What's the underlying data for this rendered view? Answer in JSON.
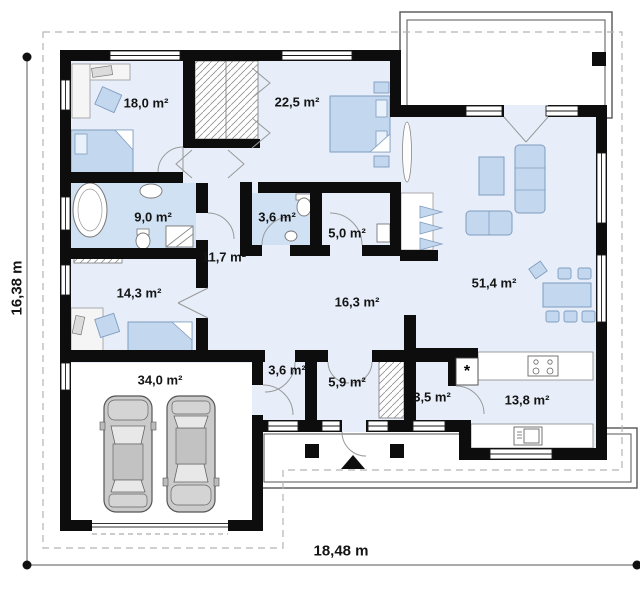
{
  "plan": {
    "rooms": {
      "bedroom_1": "18,0 m²",
      "bedroom_2": "22,5 m²",
      "bathroom": "9,0 m²",
      "wc": "3,6 m²",
      "pantry": "5,0 m²",
      "hall": "11,7 m²",
      "bedroom_3": "14,3 m²",
      "corridor": "16,3 m²",
      "living_room": "51,4 m²",
      "garage": "34,0 m²",
      "vestibule": "3,6 m²",
      "entry": "5,9 m²",
      "utility": "3,5 m²",
      "kitchen": "13,8 m²"
    },
    "dimensions": {
      "width": "18,48 m",
      "height": "16,38 m"
    },
    "utility_marker": "*",
    "colors": {
      "wall": "#0d0d0d",
      "room_fill": "#e7eef9",
      "wet_room_fill": "#cfe1f3",
      "furniture_fill": "#c3d8ee",
      "furniture_stroke": "#7f9cbf",
      "car_fill": "#cbcbcb",
      "terrace_fill": "#ffffff",
      "boundary_dash": "#b5b5b5"
    }
  }
}
